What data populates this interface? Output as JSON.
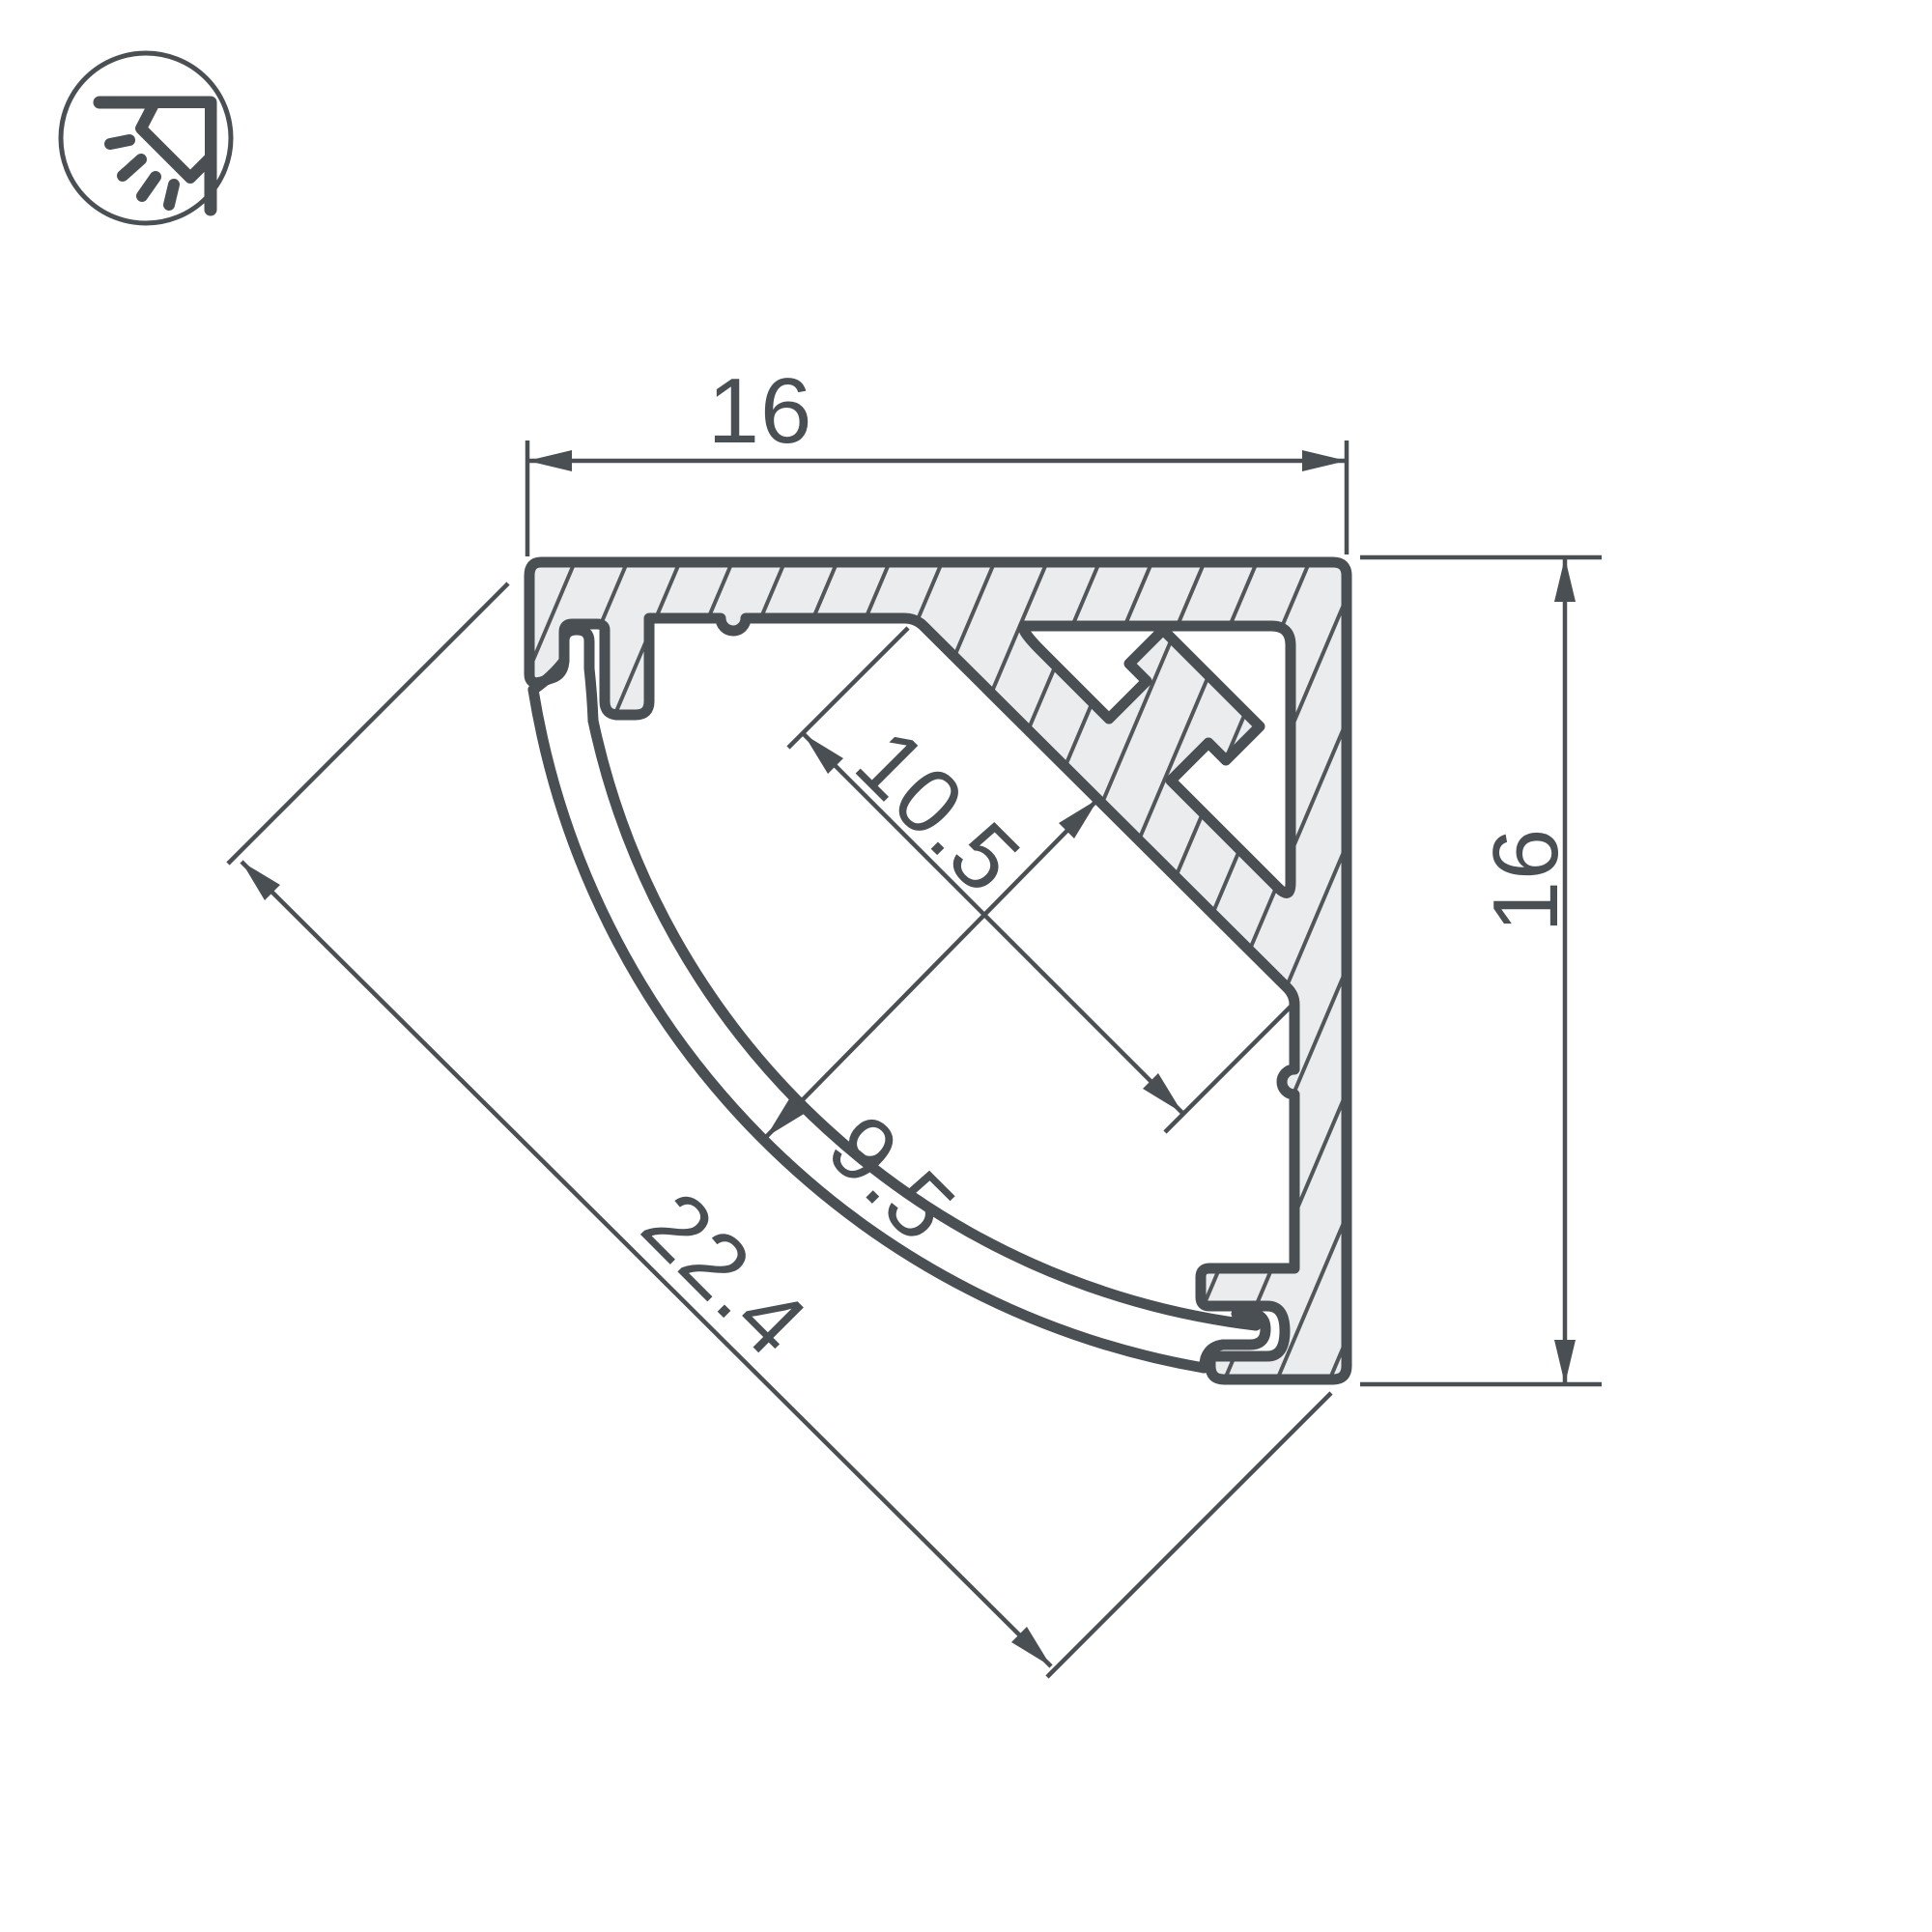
{
  "drawing": {
    "title": "LED corner profile cross-section",
    "icon": "corner-surface-light-icon",
    "dimensions": {
      "top_width": "16",
      "right_height": "16",
      "diagonal_width": "22.4",
      "platform_width": "10.5",
      "channel_depth": "9.5"
    },
    "colors": {
      "stroke": "#4a4f54",
      "text": "#4a4f54",
      "aluminum_fill": "#ebecee",
      "hatch_line": "#51565b",
      "background": "#ffffff"
    }
  }
}
